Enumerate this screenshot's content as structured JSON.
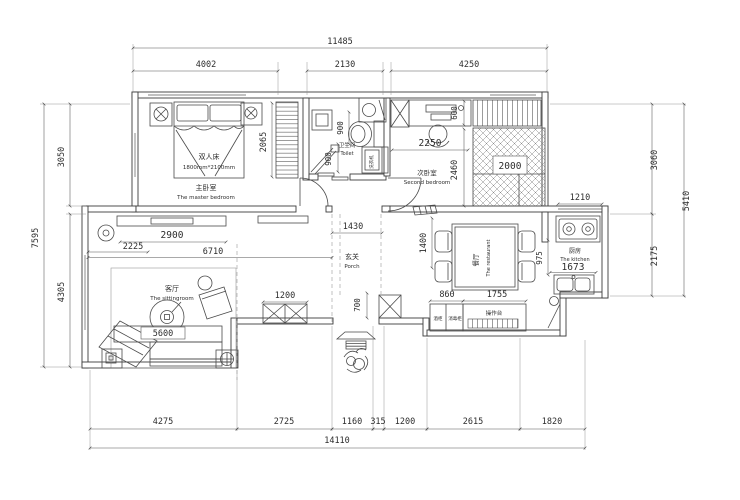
{
  "plan": {
    "border_dims": {
      "top_total": "11485",
      "top": [
        "4002",
        "2130",
        "4250"
      ],
      "left_total": "7595",
      "left": [
        "3050",
        "4305"
      ],
      "right_total": "5410",
      "right": [
        "3060",
        "2175"
      ],
      "bottom_total": "14110",
      "bottom": [
        "4275",
        "2725",
        "1160",
        "315",
        "1200",
        "2615",
        "1820"
      ]
    },
    "master": {
      "zh": "主卧室",
      "en": "The master bedroom",
      "bed": "双人床",
      "bed_size": "1800mm*2100mm",
      "wardrobe": "2065"
    },
    "bath": {
      "zh": "卫生间",
      "en": "Toilet",
      "d1": "900",
      "d2": "900",
      "washer": "洗衣机"
    },
    "bedroom2": {
      "zh": "次卧室",
      "en": "Second bedroom",
      "desk": "2250",
      "depth": "600",
      "room": "2460",
      "bed": "2000"
    },
    "kitchen": {
      "zh": "厨房",
      "en": "The kitchen",
      "window": "1210",
      "counter": "1673",
      "pass": "975"
    },
    "dining": {
      "zh": "餐厅",
      "en": "The restaurant",
      "depth": "1400",
      "w1": "860",
      "w2": "1755",
      "cab1": "酒柜",
      "cab2": "消毒柜",
      "counter": "操作台"
    },
    "porch": {
      "zh": "玄关",
      "en": "Porch",
      "hall": "1430",
      "col": "700"
    },
    "living": {
      "zh": "客厅",
      "en": "The sittingroom",
      "d1": "2225",
      "d2": "2900",
      "d3": "6710",
      "col": "1200",
      "sofa": "5600"
    }
  }
}
